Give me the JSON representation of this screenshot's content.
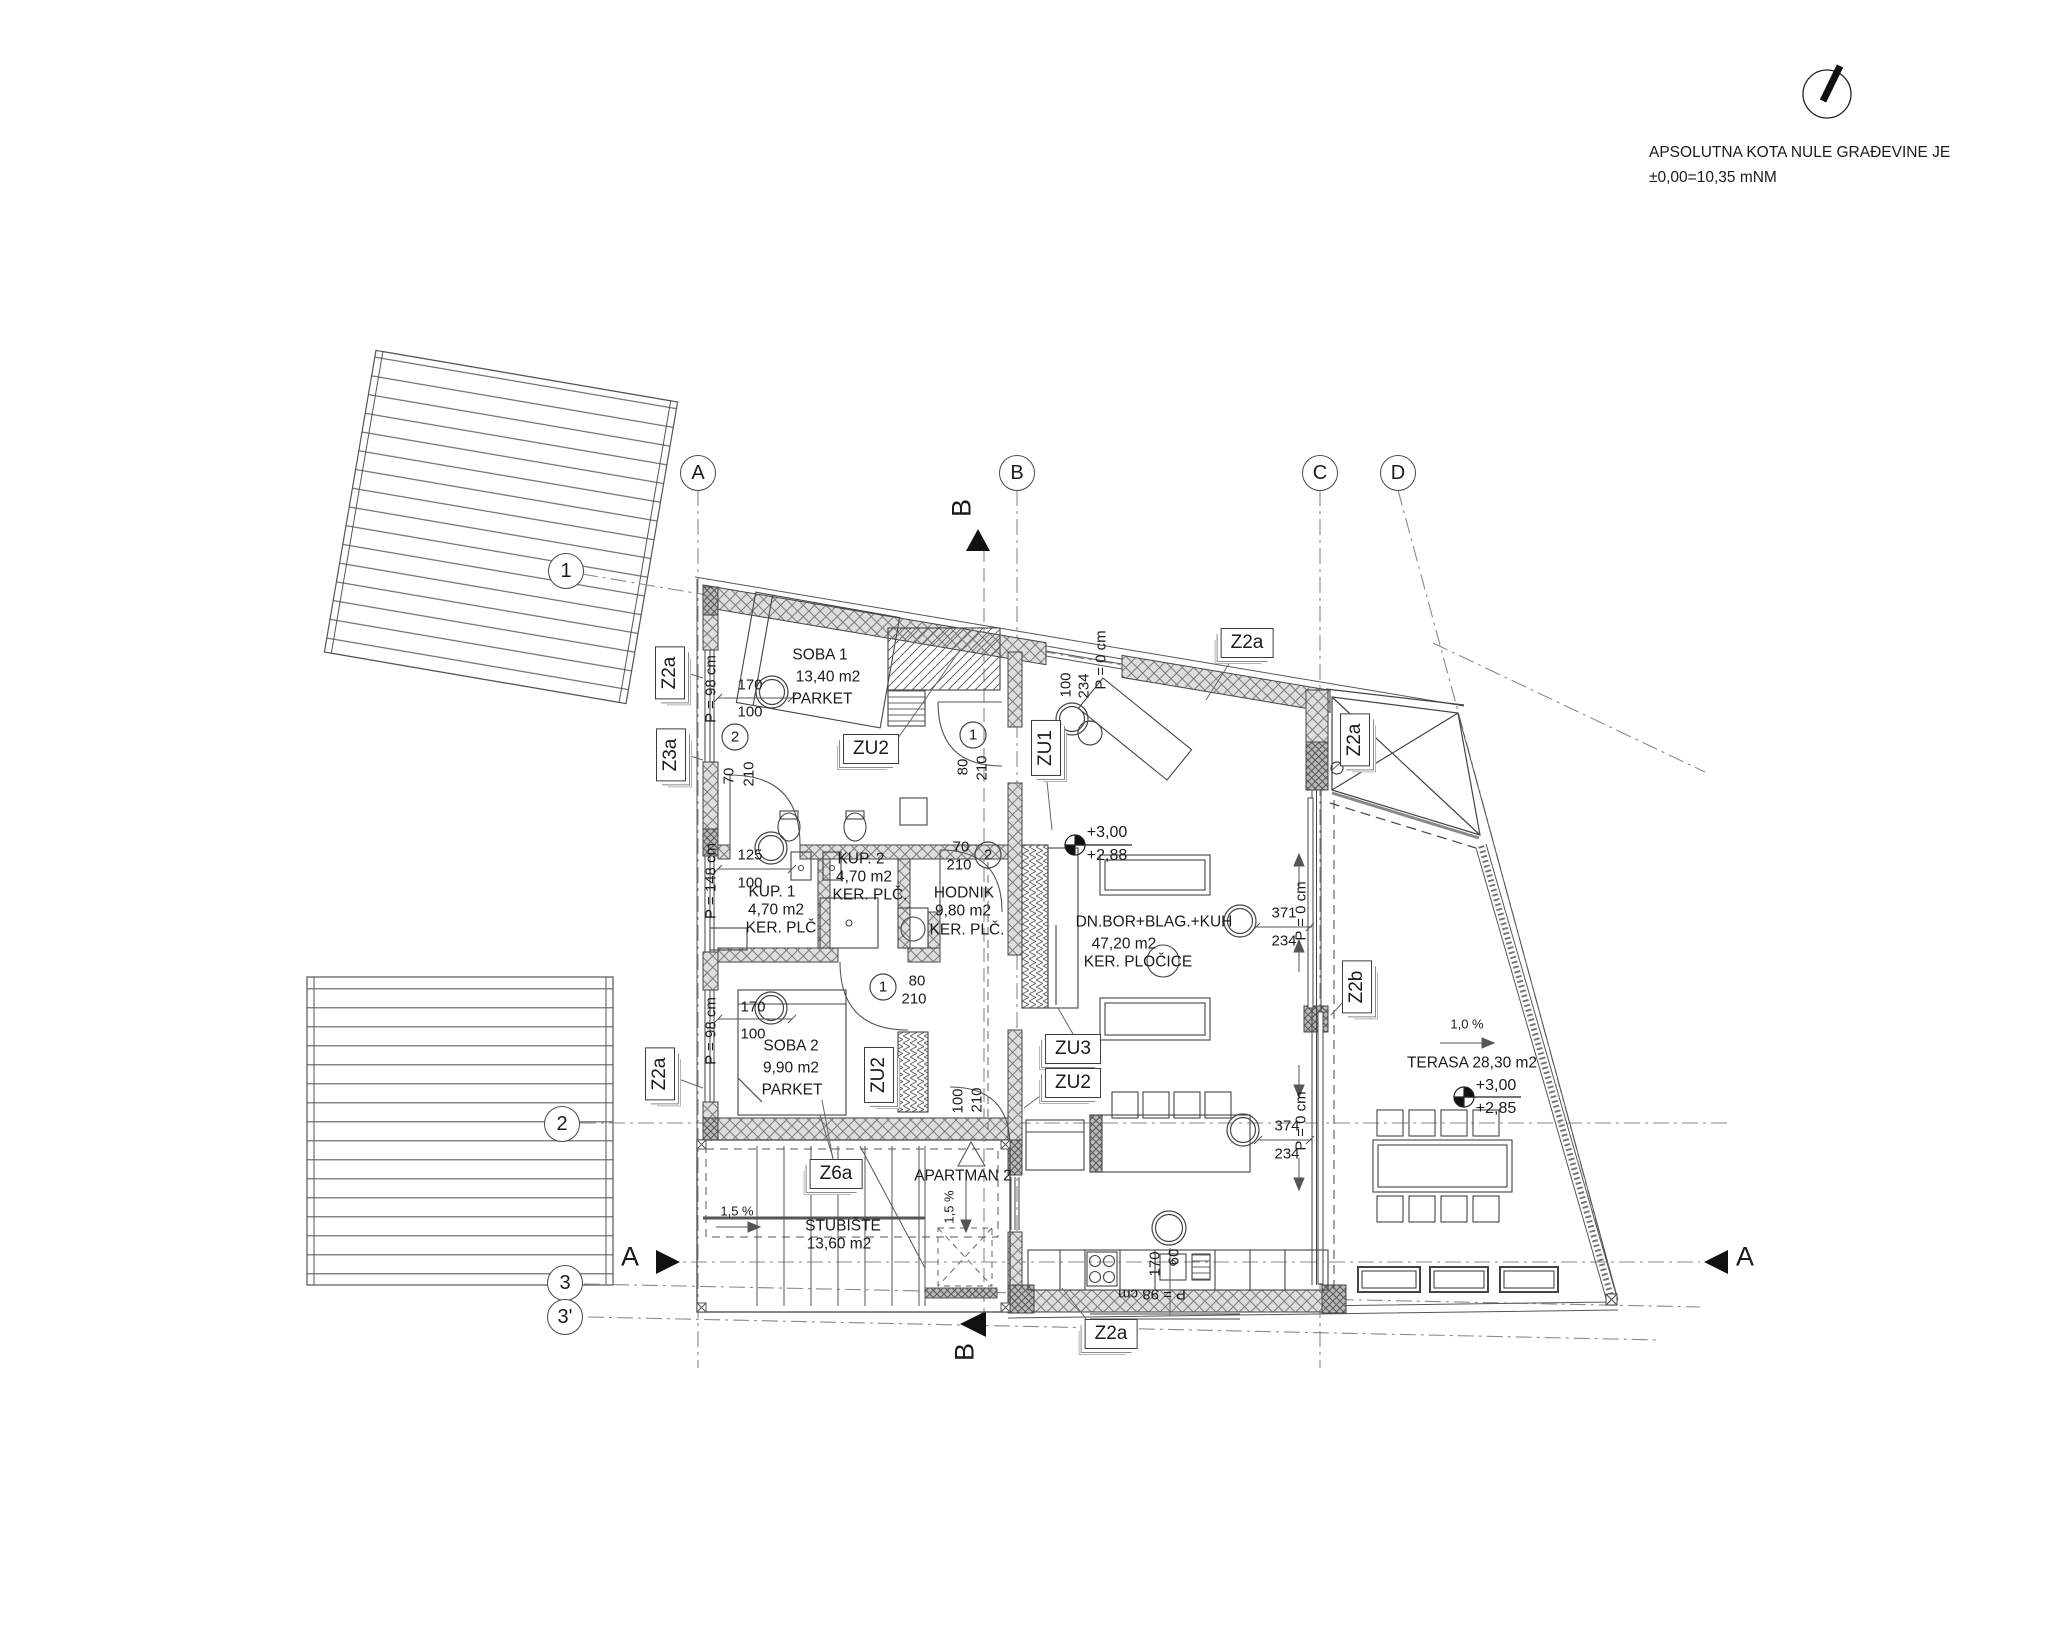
{
  "annotation": {
    "line1": "APSOLUTNA KOTA NULE GRAĐEVINE JE",
    "line2": "±0,00=10,35 mNM"
  },
  "grid": {
    "a": "A",
    "b": "B",
    "c": "C",
    "d": "D",
    "r1": "1",
    "r2": "2",
    "r3": "3",
    "r3p": "3'"
  },
  "sections": {
    "a": "A",
    "b": "B"
  },
  "rooms": {
    "soba1": {
      "name": "SOBA 1",
      "area": "13,40 m2",
      "floor": "PARKET"
    },
    "kup1": {
      "name": "KUP. 1",
      "area": "4,70 m2",
      "floor": "KER. PLČ"
    },
    "kup2": {
      "name": "KUP. 2",
      "area": "4,70 m2",
      "floor": "KER. PLČ."
    },
    "hodnik": {
      "name": "HODNIK",
      "area": "9,80 m2",
      "floor": "KER. PLČ."
    },
    "soba2": {
      "name": "SOBA 2",
      "area": "9,90 m2",
      "floor": "PARKET"
    },
    "dnevni": {
      "name": "DN.BOR+BLAG.+KUH",
      "area": "47,20 m2",
      "floor": "KER. PLOČICE"
    },
    "terasa": {
      "name": "TERASA 28,30 m2"
    },
    "stubiste": {
      "name": "STUBIŠTE",
      "area": "13,60 m2"
    },
    "apartman": {
      "name": "APARTMAN 2"
    }
  },
  "tags": {
    "z2a": "Z2a",
    "z3a": "Z3a",
    "z2b": "Z2b",
    "zu1": "ZU1",
    "zu2": "ZU2",
    "zu3": "ZU3",
    "z6a": "Z6a"
  },
  "dims": {
    "win_soba1": {
      "w": "170",
      "h": "100",
      "parapet": "P = 98 cm"
    },
    "win_kup": {
      "w": "125",
      "h": "100",
      "parapet": "P = 148 cm"
    },
    "win_soba2": {
      "w": "170",
      "h": "100",
      "parapet": "P = 98 cm"
    },
    "door_kup1": {
      "w": "70",
      "h": "210"
    },
    "door_soba1": {
      "w": "80",
      "h": "210"
    },
    "door_kup2": {
      "w": "70",
      "h": "210"
    },
    "door_soba2": {
      "w": "80",
      "h": "210"
    },
    "door_entry": {
      "w": "100",
      "h": "210"
    },
    "door_balcony": {
      "w": "100",
      "h": "234",
      "parapet": "P = 0 cm"
    },
    "glass_upper": {
      "w": "371",
      "h": "234",
      "parapet": "P = 0 cm"
    },
    "glass_lower": {
      "w": "374",
      "h": "234",
      "parapet": "P = 0 cm"
    },
    "win_kitchen": {
      "w": "170",
      "h": "60",
      "parapet": "P = 98 cm"
    }
  },
  "levels": {
    "living": {
      "top": "+3,00",
      "bottom": "+2,88"
    },
    "terrace": {
      "top": "+3,00",
      "bottom": "+2,85"
    }
  },
  "slopes": {
    "stairs": "1,5 %",
    "entry": "1,5 %",
    "terrace": "1,0 %"
  },
  "door_numbers": {
    "n1": "1",
    "n2": "2"
  }
}
